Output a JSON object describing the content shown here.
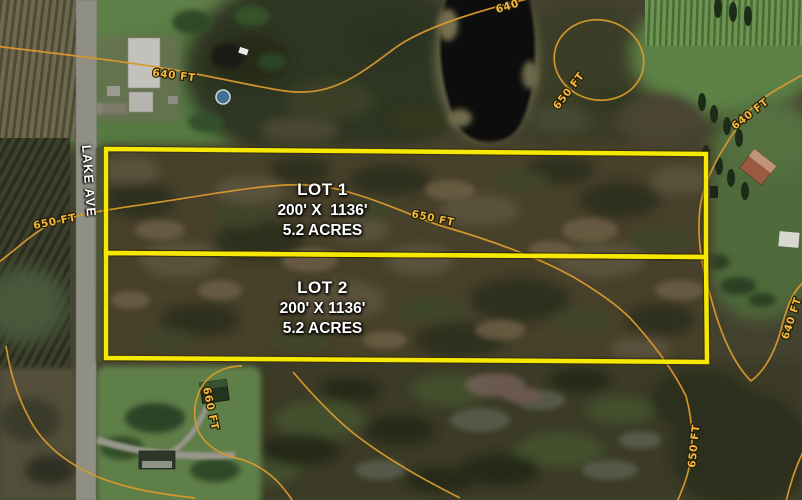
{
  "map": {
    "description": "Aerial satellite parcel map with two surveyed lots and elevation contour lines",
    "road": {
      "label": "LAKE AVE"
    },
    "lots": [
      {
        "name": "LOT 1",
        "dimensions": "200' X  1136'",
        "area": "5.2 ACRES"
      },
      {
        "name": "LOT 2",
        "dimensions": "200' X 1136'",
        "area": "5.2 ACRES"
      }
    ],
    "contour_labels": [
      {
        "text": "640"
      },
      {
        "text": "640 FT"
      },
      {
        "text": "650 FT"
      },
      {
        "text": "640 FT"
      },
      {
        "text": "650 FT"
      },
      {
        "text": "650 FT"
      },
      {
        "text": "640 FT"
      },
      {
        "text": "660 FT"
      },
      {
        "text": "650 FT"
      }
    ],
    "colors": {
      "lot_boundary": "#f6e800",
      "contour_line": "#d9992e",
      "contour_label_text": "#f5b93e",
      "lot_label_text": "#ffffff",
      "road_surface": "#908f84"
    }
  }
}
